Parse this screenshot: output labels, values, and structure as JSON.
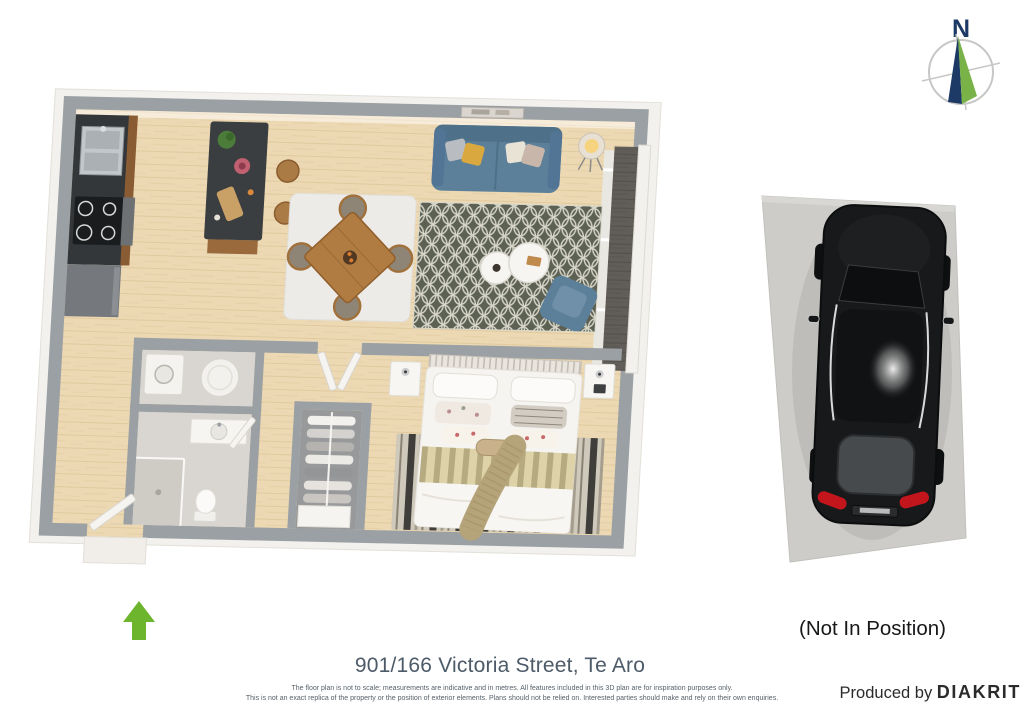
{
  "window": {
    "background": "#ffffff",
    "width": 1024,
    "height": 724
  },
  "compass": {
    "label": "N",
    "north_color": "#1d3a66",
    "needle_green": "#79b347",
    "ring_color": "#c7c7c5"
  },
  "floor_plan": {
    "palette": {
      "walls": "#9aa0a3",
      "wall_faces": "#f3f1ed",
      "wood_floor": "#ecd9b3",
      "balcony_deck": "#615d58",
      "bathroom_tile": "#d9d6d1",
      "sofa_blue": "#5d809a",
      "area_rug_dark": "#5c6153",
      "rug_lattice": "#d7d6c9",
      "dining_wood": "#b07c42",
      "island_stone": "#3b3e41",
      "bedding_white": "#f6f4f0",
      "throw_tan": "#b5a379",
      "entrance_arrow": "#6cb52d"
    }
  },
  "parking": {
    "status_label": "(Not In Position)",
    "slab_color": "#cdccc8",
    "car_color": "#17191b",
    "taillight_color": "#c3161c"
  },
  "labels": {
    "title": "901/166 Victoria Street, Te Aro",
    "disclaimer_line1": "The floor plan is not to scale; measurements are indicative and in metres. All features included in this 3D plan are for inspiration purposes only.",
    "disclaimer_line2": "This is not an exact replica of the property or the position of exterior elements. Plans should not be relied on. Interested parties should make and rely on their own enquiries.",
    "produced_by": "Produced by",
    "brand": "DIAKRIT"
  }
}
